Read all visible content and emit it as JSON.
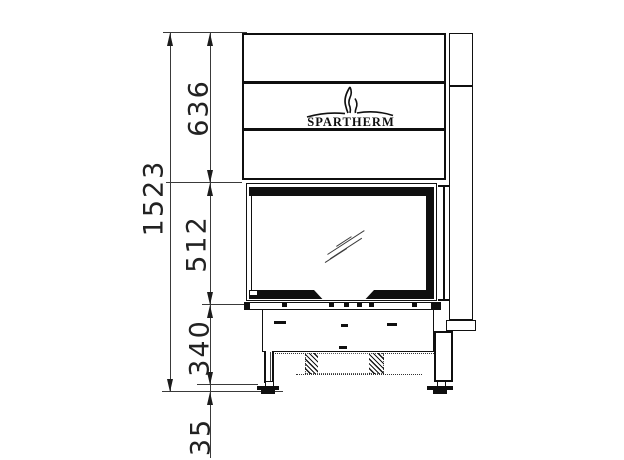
{
  "drawing": {
    "brand": {
      "wordmark": "SPARTHERM"
    },
    "dimensions": {
      "total_height": "1523",
      "hood_height": "636",
      "door_height": "512",
      "base_height": "340",
      "foot_height": "35"
    },
    "icons": {
      "logo_flame": "flame-icon"
    },
    "colors": {
      "background": "#ffffff",
      "drawing_line": "#111111",
      "dimension_line": "#3a3a3a",
      "text": "#222222"
    }
  }
}
